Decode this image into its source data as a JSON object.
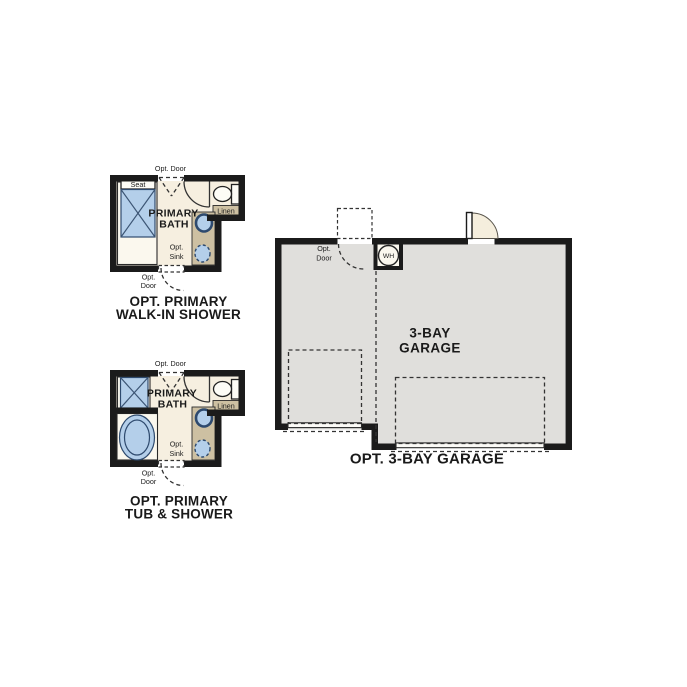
{
  "background_color": "#ffffff",
  "colors": {
    "wall": "#1b1b1b",
    "bath_floor": "#f6efe0",
    "room_white": "#fbf8ee",
    "counter_tan": "#cdc0a2",
    "fixture_blue": "#b4cfea",
    "fixture_outline": "#2e4a6e",
    "garage_floor": "#e0dfdc",
    "door_swing_fill": "#f5eedd",
    "text": "#1a1a1a"
  },
  "plans": {
    "walk_in_shower": {
      "title_line1": "OPT. PRIMARY",
      "title_line2": "WALK-IN SHOWER",
      "opt_door_top": "Opt. Door",
      "seat": "Seat",
      "room_line1": "PRIMARY",
      "room_line2": "BATH",
      "linen": "Linen",
      "opt_sink_line1": "Opt.",
      "opt_sink_line2": "Sink",
      "opt_door_bottom_line1": "Opt.",
      "opt_door_bottom_line2": "Door"
    },
    "tub_shower": {
      "title_line1": "OPT. PRIMARY",
      "title_line2": "TUB & SHOWER",
      "opt_door_top": "Opt. Door",
      "room_line1": "PRIMARY",
      "room_line2": "BATH",
      "linen": "Linen",
      "opt_sink_line1": "Opt.",
      "opt_sink_line2": "Sink",
      "opt_door_bottom_line1": "Opt.",
      "opt_door_bottom_line2": "Door"
    },
    "garage": {
      "title": "OPT. 3-BAY GARAGE",
      "room_line1": "3-BAY",
      "room_line2": "GARAGE",
      "opt_door_line1": "Opt.",
      "opt_door_line2": "Door",
      "water_heater": "WH"
    }
  }
}
